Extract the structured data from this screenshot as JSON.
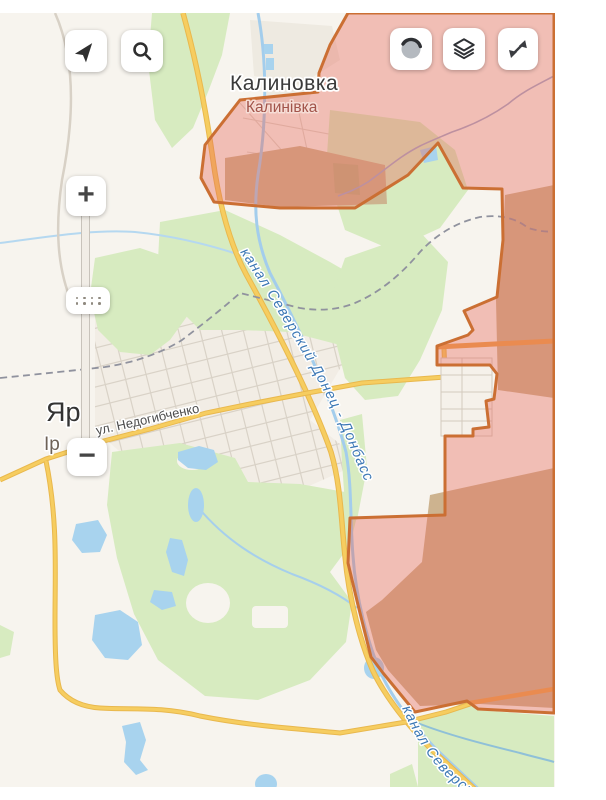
{
  "map_labels": {
    "settlement_ru": "Калиновка",
    "settlement_uk": "Калинівка",
    "canal": "канал Северский Донец - Донбасс",
    "canal_south": "канал Северский Донец - Донбасс",
    "street": "ул. Недогибченко",
    "place_partial_line1": "Яр",
    "place_partial_line2": "Ір"
  },
  "controls": {
    "zoom_in": "+",
    "zoom_out": "−",
    "locate_icon": "navigation-arrow",
    "search_icon": "magnifier",
    "map_type_icon": "globe-circle",
    "layers_icon": "stacked-layers",
    "fullscreen_icon": "expand-arrows",
    "slider_handle_icon": "drag-dots"
  },
  "colors": {
    "zone_fill": "#e7675a",
    "zone_border": "#cb6f33",
    "water": "#a8d3ee",
    "forest": "#d7ebc0",
    "land": "#f7f4ee",
    "road_yellow": "#f6cd60",
    "road_orange": "#eca24b",
    "railway": "#90929e",
    "field_tan": "#cdb38f",
    "canal_label_text": "#3c78b5"
  }
}
